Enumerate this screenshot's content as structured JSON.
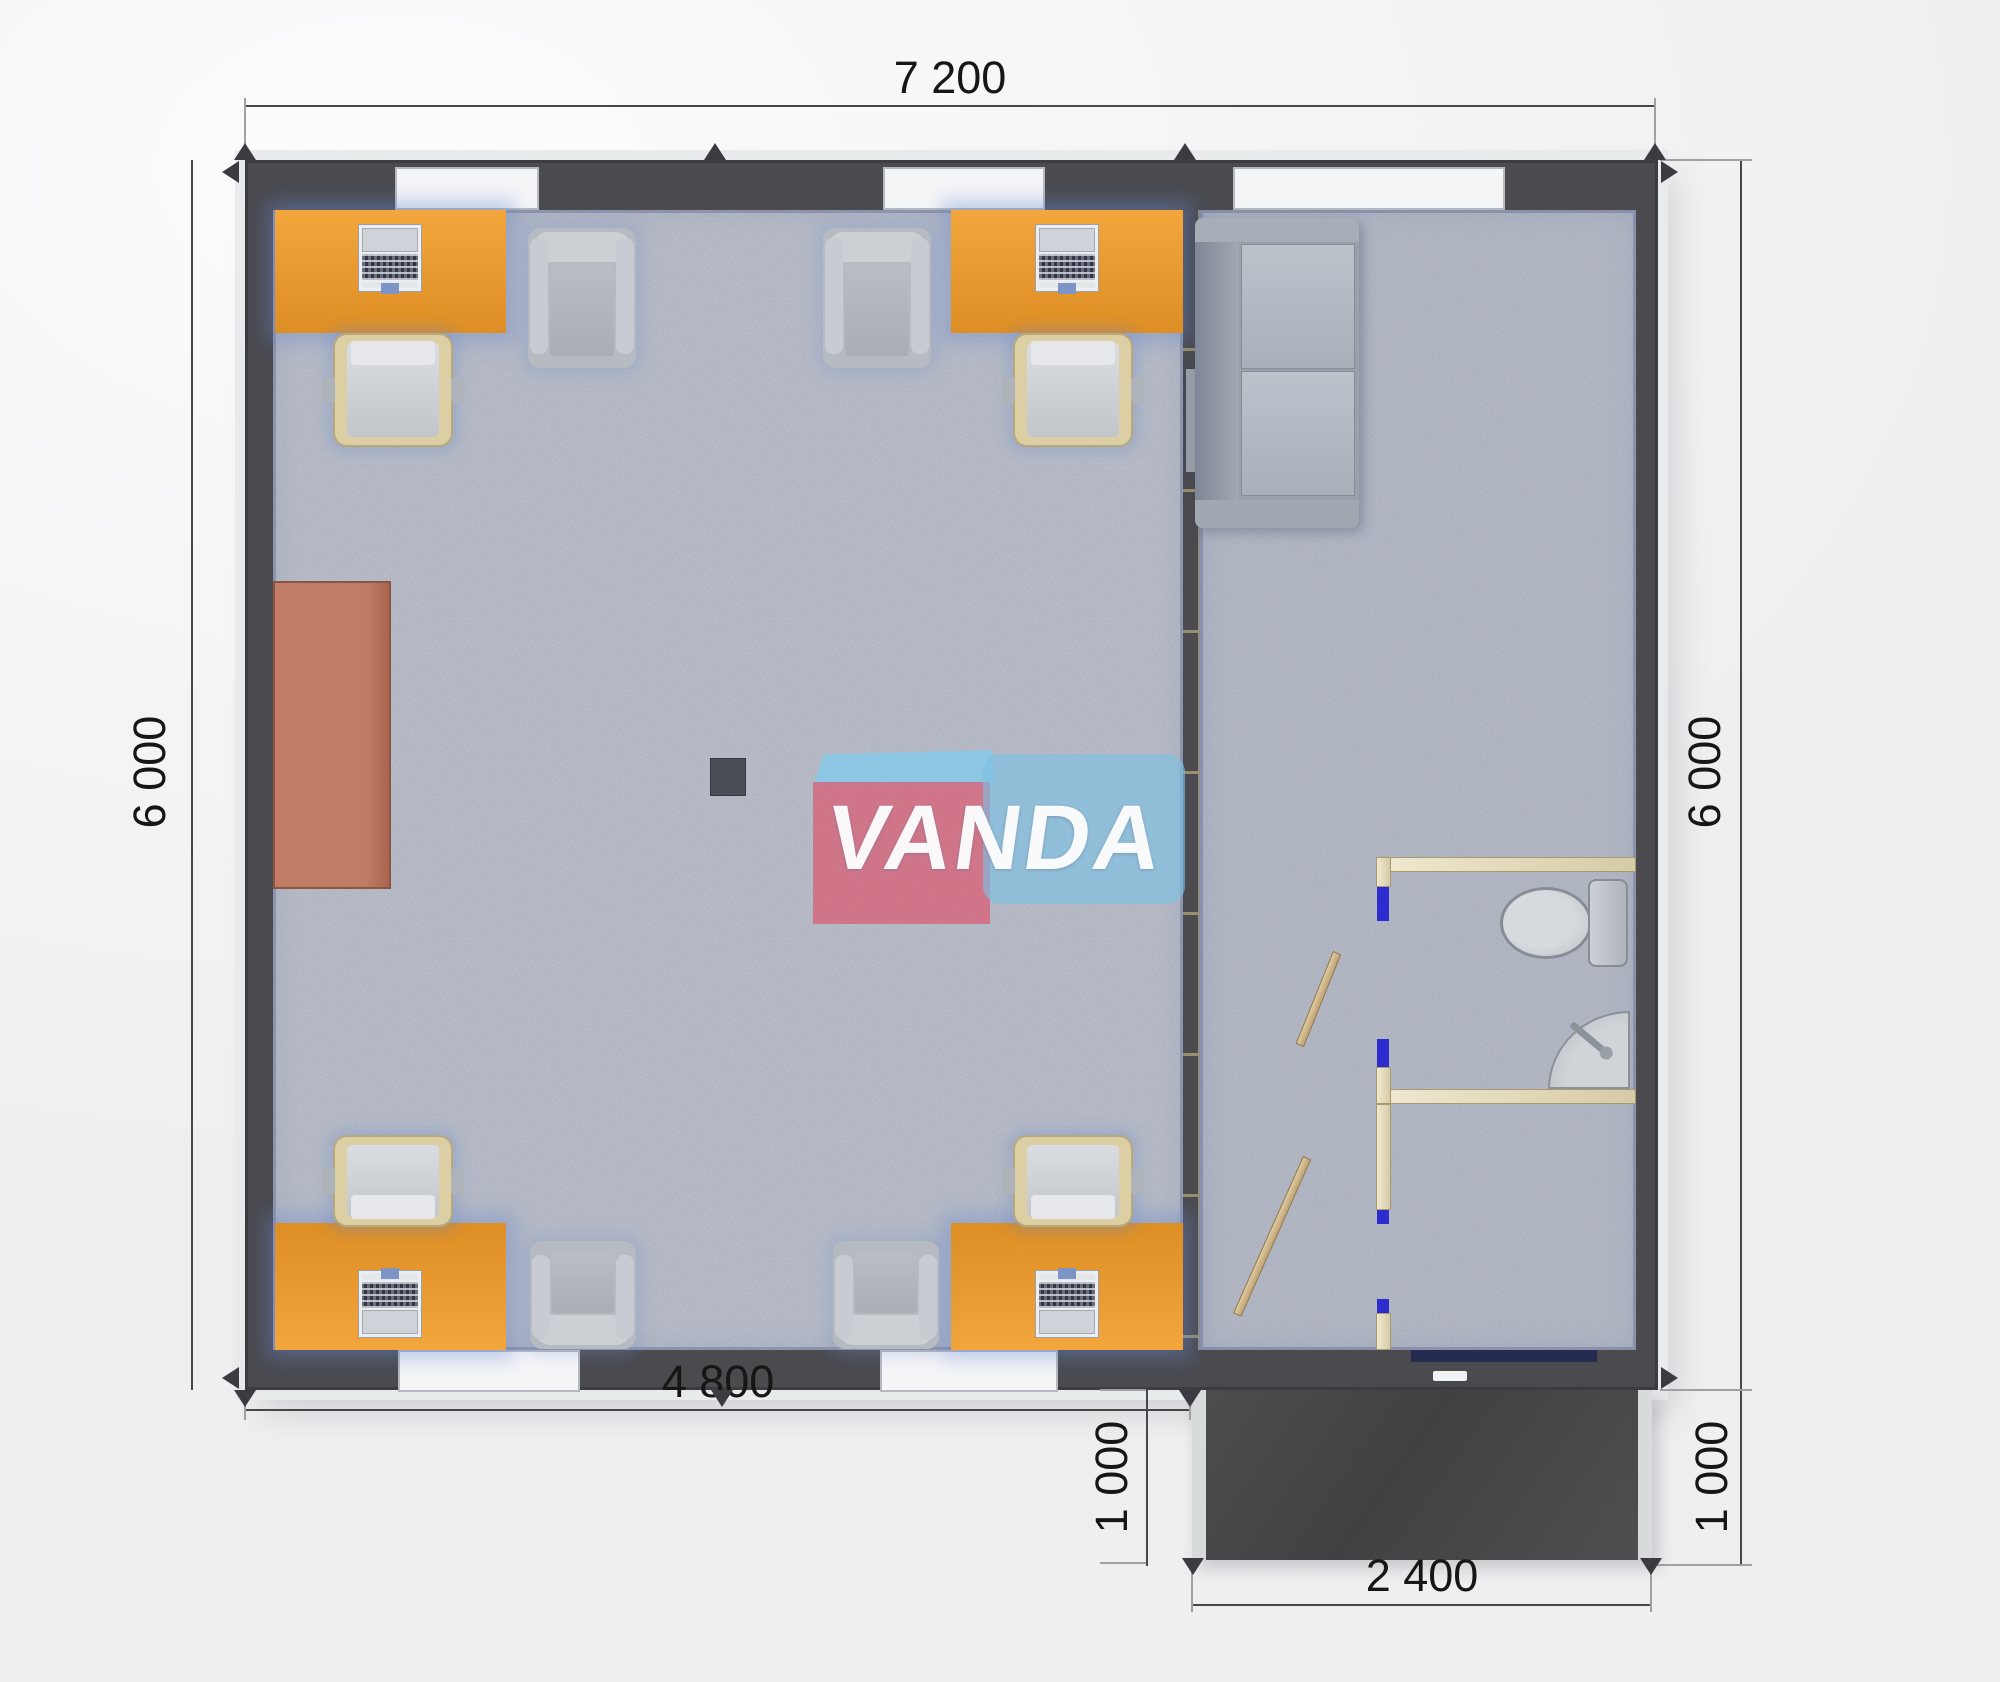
{
  "plan": {
    "watermark_text": "VANDA",
    "dimensions": {
      "top_width": "7 200",
      "left_height": "6 000",
      "right_height": "6 000",
      "bottom_left_width": "4 800",
      "porch_height_left": "1 000",
      "porch_height_right": "1 000",
      "porch_width": "2 400"
    },
    "colors": {
      "wall": "#4a4a4f",
      "carpet": "#bcc1cb",
      "desk_orange": "#e99a2f",
      "partition_beige": "#e9e2cb",
      "door_leaf_tan": "#d5bd92",
      "door_jamb_blue": "#2d2dcf",
      "porch_dark": "#47474a",
      "side_table_brown": "#b4705a",
      "logo_red": "#d96076",
      "logo_blue": "#7dc0e3"
    }
  }
}
